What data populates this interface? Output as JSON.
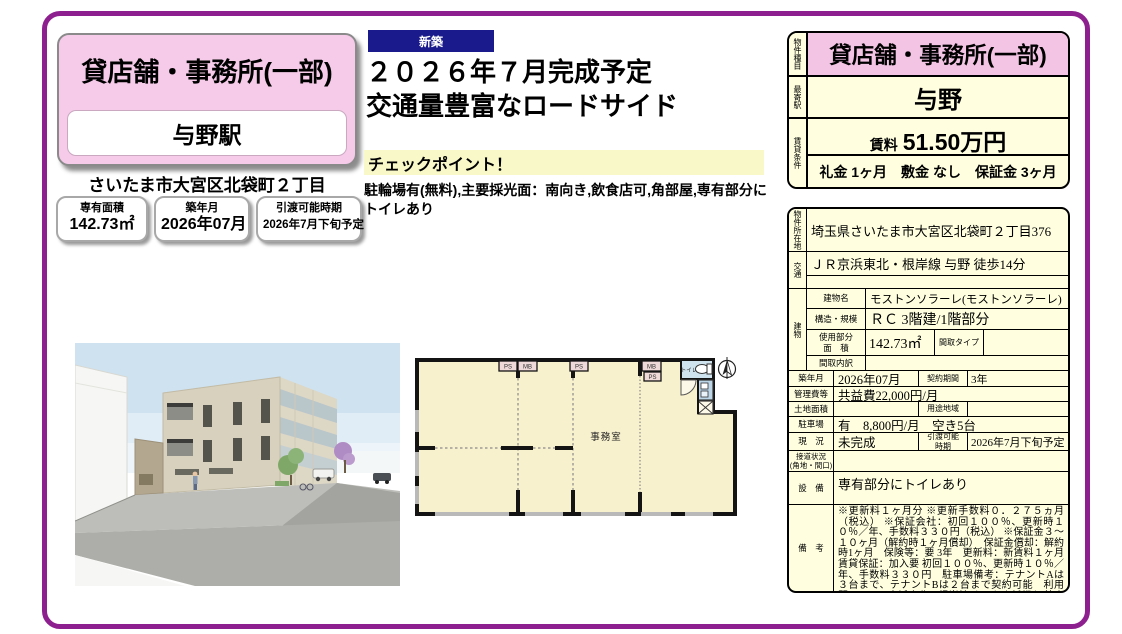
{
  "colors": {
    "accent_purple": "#8e1f8e",
    "pink": "#f6cbe9",
    "pink_deep": "#f3c4e3",
    "cream": "#ffffe0",
    "navy_badge": "#1a1a8c",
    "checkpoint_highlight": "#f8f8c8",
    "floorplan_fill": "#f8f1cd"
  },
  "left_card": {
    "title": "貸店舗・事務所(一部)",
    "station": "与野駅",
    "address": "さいたま市大宮区北袋町２丁目",
    "pills": [
      {
        "label": "専有面積",
        "value": "142.73㎡"
      },
      {
        "label": "築年月",
        "value": "2026年07月"
      },
      {
        "label": "引渡可能時期",
        "value": "2026年7月下旬予定"
      }
    ]
  },
  "headline": {
    "badge": "新築",
    "line1": "２０２６年７月完成予定",
    "line2": "交通量豊富なロードサイド",
    "checkpoint_title": "チェックポイント！",
    "checkpoint_body": "駐輪場有(無料),主要採光面：南向き,飲食店可,角部屋,専有部分にトイレあり"
  },
  "summary_table": {
    "property_type_label": "物件種目",
    "property_type": "貸店舗・事務所(一部)",
    "station_label": "最寄駅",
    "station": "与野",
    "terms_label": "賃貸条件",
    "rent_label": "賃料",
    "rent": "51.50万円",
    "terms": "礼金 1ヶ月　敷金 なし　保証金 3ヶ月"
  },
  "detail_table": {
    "location_label": "物件所在地",
    "location": "埼玉県さいたま市大宮区北袋町２丁目376",
    "access_label": "交通",
    "access": "ＪＲ京浜東北・根岸線 与野 徒歩14分",
    "access2": "",
    "building_label": "建物",
    "building_name_label": "建物名",
    "building_name": "モストンソラーレ(モストンソラーレ)　A",
    "structure_label": "構造・規模",
    "structure": "ＲＣ 3階建/1階部分",
    "area_label": "使用部分\n面　積",
    "area": "142.73㎡",
    "layout_type_label": "間取タイプ",
    "layout_type": "",
    "layout_detail_label": "間取内訳",
    "layout_detail": "",
    "built_label": "築年月",
    "built": "2026年07月",
    "contract_label": "契約期間",
    "contract": "3年",
    "mgmt_label": "管理費等",
    "mgmt": "共益費22,000円/月",
    "land_label": "土地面積",
    "land": "",
    "zoning_label": "用途地域",
    "zoning": "",
    "parking_label": "駐車場",
    "parking": "有　8,800円/月　空き5台",
    "status_label": "現　況",
    "status": "未完成",
    "delivery_label": "引渡可能\n時期",
    "delivery": "2026年7月下旬予定",
    "road_label": "接道状況\n(角地・間口)",
    "road": "",
    "equipment_label": "設　備",
    "equipment": "専有部分にトイレあり",
    "notes_label": "備　考",
    "notes": "※更新料１ヶ月分 ※更新手数料０．２７５ヵ月（税込） ※保証会社：初回１００％、更新時１０％／年、手数料３３０円（税込） ※保証金３～１０ヶ月（解約時１ヶ月償却）　保証金償却：解約時1ヶ月　保険等：要 3年　更新料：新賃料１ヶ月 賃貸保証：加入要 初回１００％、更新時１０％／年、手数料３３０円　駐車場備考：テナントAは３台まで、テナントBは２台まで契約可能　利用駅１：ＪＲ京浜東北・根岸線 さいたま新都心 徒歩20分"
  },
  "floorplan": {
    "office": "事務室",
    "toilet": "トイレ",
    "ps": "PS",
    "mb": "MB"
  }
}
